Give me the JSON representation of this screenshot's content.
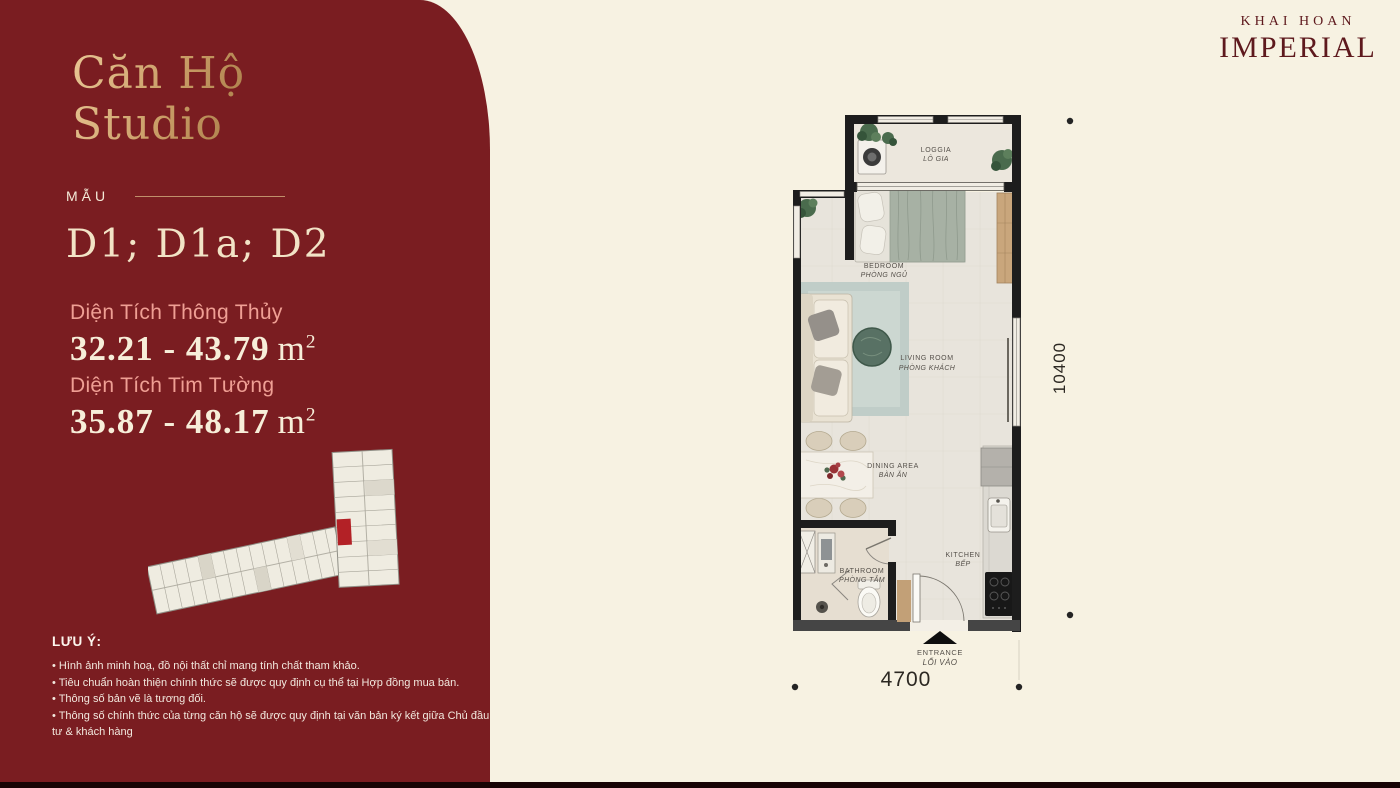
{
  "brand": {
    "name_top": "KHAI HOAN",
    "name_main": "IMPERIAL"
  },
  "sidebar": {
    "title_line1": "Căn Hộ",
    "title_line2": "Studio",
    "model_label": "MẪU",
    "model_codes": "D1; D1a; D2",
    "area_net_label": "Diện Tích Thông Thủy",
    "area_net_value": "32.21 - 43.79",
    "area_gross_label": "Diện Tích Tim Tường",
    "area_gross_value": "35.87 - 48.17",
    "area_unit": "m",
    "area_unit_exp": "2",
    "notes_title": "LƯU Ý:",
    "notes": [
      "• Hình ảnh minh hoạ, đồ nội thất chỉ mang tính chất tham khảo.",
      "• Tiêu chuẩn hoàn thiện chính thức sẽ được quy định cụ thể tại Hợp đồng mua bán.",
      "• Thông số bản vẽ là tương đối.",
      "• Thông số chính thức của từng căn hộ sẽ được quy định tại văn bản ký kết giữa Chủ đầu tư & khách hàng"
    ]
  },
  "floor_plan": {
    "rooms": {
      "loggia": {
        "en": "LOGGIA",
        "vi": "LÔ GIA"
      },
      "bedroom": {
        "en": "BEDROOM",
        "vi": "PHÒNG NGỦ"
      },
      "living": {
        "en": "LIVING ROOM",
        "vi": "PHÒNG KHÁCH"
      },
      "dining": {
        "en": "DINING AREA",
        "vi": "BÀN ĂN"
      },
      "kitchen": {
        "en": "KITCHEN",
        "vi": "BẾP"
      },
      "bathroom": {
        "en": "BATHROOM",
        "vi": "PHÒNG TẮM"
      }
    },
    "entrance": {
      "en": "ENTRANCE",
      "vi": "LỐI VÀO"
    },
    "dimensions": {
      "width_mm": "4700",
      "height_mm": "10400"
    }
  },
  "colors": {
    "sidebar_bg": "#7a1d21",
    "page_bg": "#f7f2e2",
    "gold_title": "#cfa26d",
    "cream_text": "#f7eed9",
    "pink_label": "#ef9f94",
    "brand_red": "#5e191d",
    "highlight_unit_red": "#b32126",
    "wall_black": "#1d1d1d"
  }
}
